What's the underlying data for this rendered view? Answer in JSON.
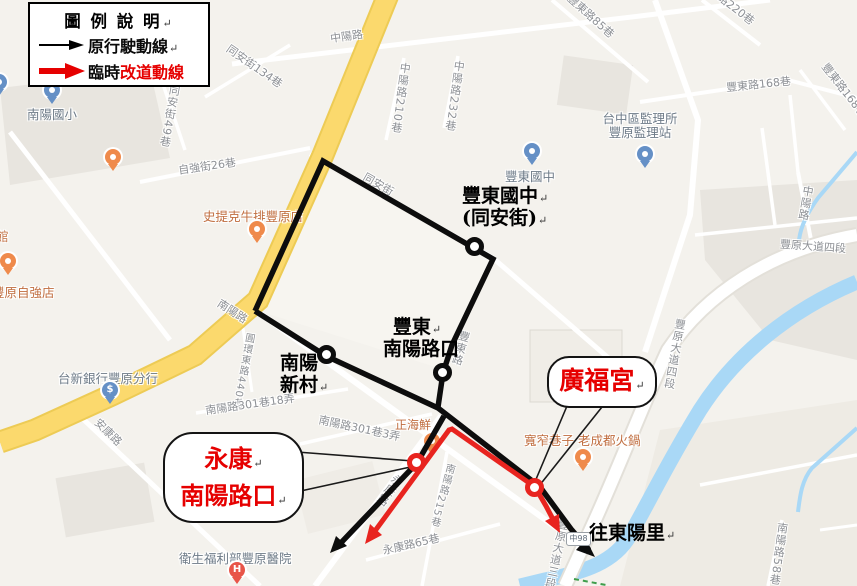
{
  "legend": {
    "title": "圖 例 說 明",
    "original_route": "原行駛動線",
    "detour_prefix": "臨時",
    "detour_suffix": "改道動線"
  },
  "pmark": "↵",
  "overlay_labels": {
    "fengdong_school": {
      "line1": "豐東國中",
      "line2": "(同安街)"
    },
    "fengdong_nanyang": {
      "line1": "豐東",
      "line2": "南陽路口"
    },
    "nanyang_village": {
      "line1": "南陽",
      "line2": "新村"
    },
    "to_dongyang": "往東陽里"
  },
  "callouts": {
    "yongkang_nanyang": {
      "line1": "永康",
      "line2": "南陽路口"
    },
    "guangfu_temple": {
      "label": "廣福宮"
    }
  },
  "road_shield": "中98",
  "pois": [
    {
      "name": "南陽國小",
      "type": "school"
    },
    {
      "name": "豐東國中",
      "type": "school"
    },
    {
      "name": "台中區監理所",
      "name2": "豐原監理站",
      "type": "government"
    },
    {
      "name": "",
      "type": "cafe"
    },
    {
      "name": "史提克牛排豐原店",
      "type": "restaurant"
    },
    {
      "name": "豐原自強店",
      "type": "restaurant"
    },
    {
      "name": "台新銀行豐原分行",
      "type": "bank"
    },
    {
      "name": "正海鮮",
      "type": "restaurant"
    },
    {
      "name": "寬窄巷子 老成都火鍋",
      "type": "restaurant"
    },
    {
      "name": "衛生福利部豐原醫院",
      "type": "hospital"
    },
    {
      "name": "館",
      "type": "partial-label"
    }
  ],
  "streets": [
    "中陽路",
    "中陽路210巷",
    "中陽路232巷",
    "同安街134巷",
    "同安街49巷",
    "自強街26巷",
    "豐東路85巷",
    "豐東路220巷",
    "豐東路168巷",
    "豐東路168巷",
    "同安街",
    "南陽路",
    "圓環東路440巷",
    "南陽路301巷18弄",
    "南陽路301巷3弄",
    "豐東路",
    "南陽路215巷",
    "永康路",
    "永康路65巷",
    "安康路",
    "豐原大道四段",
    "豐原大道四段",
    "中陽路",
    "豐原大道三段",
    "南陽路58巷"
  ],
  "colors": {
    "route-black": "#0d0d0d",
    "route-red": "#e8241f",
    "text-red": "#e60000",
    "map-bg": "#f4f2ed",
    "block": "#e8e5df",
    "block-light": "#f7f5f0",
    "block-warm": "#eeebe4",
    "water": "#a9d8f6",
    "road-yellow": "#fbd96d",
    "road-casing": "#e3e0d9",
    "poi-orange": "#ef8a4b",
    "poi-text": "#c06d3f",
    "pin-blue": "#6590c6",
    "inst-label": "#6e7b88",
    "hospital-red": "#e85549",
    "street-label": "#8d9095"
  }
}
